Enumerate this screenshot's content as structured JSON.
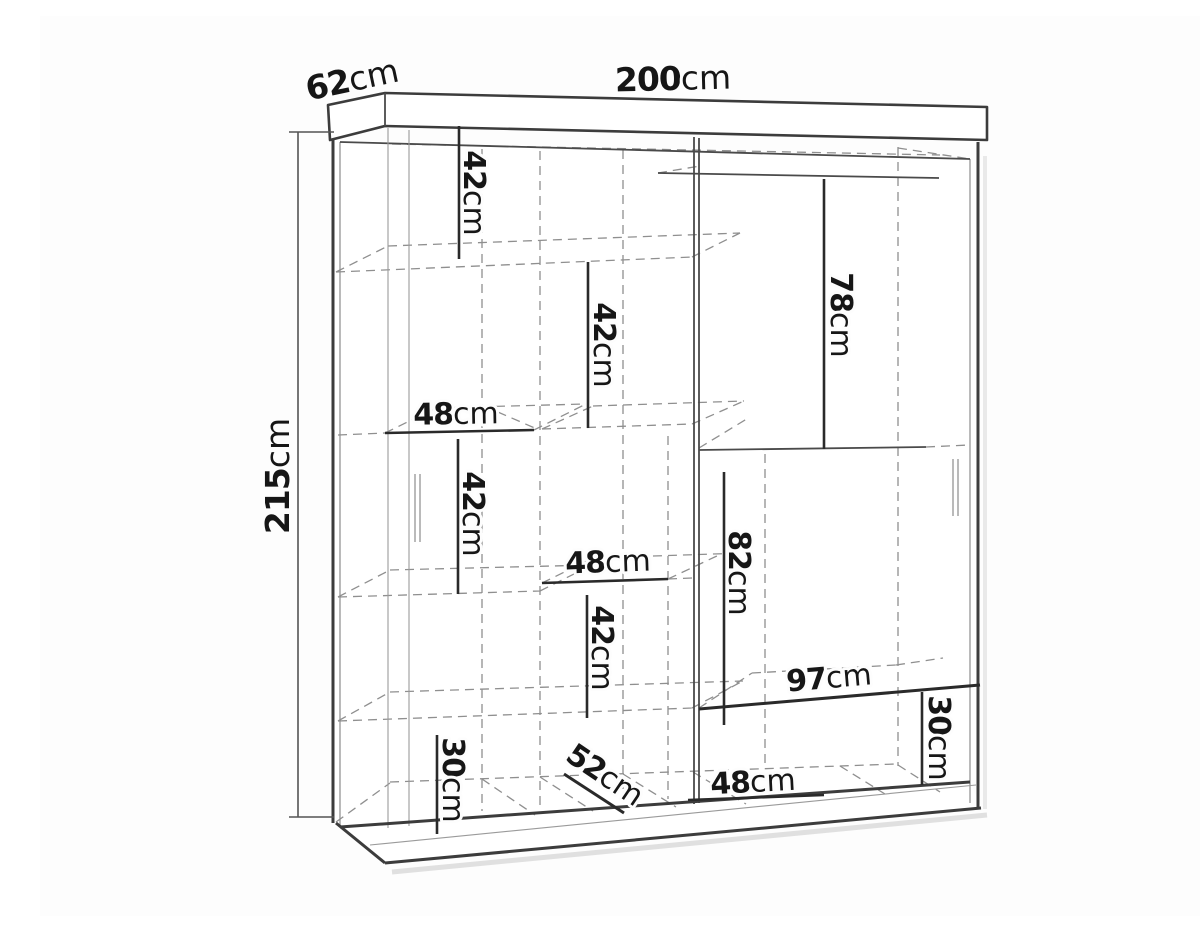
{
  "diagram": {
    "description": "Technical dimension line drawing of a two-door sliding wardrobe shown in perspective with internal shelf measurements",
    "unit": "cm",
    "background_color": "#fdfdfd",
    "line_color": "#3c3c3c",
    "hidden_line_color": "#8f8f8f",
    "text_color": "#161616"
  },
  "overall": {
    "width": {
      "num": "200",
      "unit": "cm"
    },
    "depth": {
      "num": "62",
      "unit": "cm"
    },
    "height": {
      "num": "215",
      "unit": "cm"
    }
  },
  "internal": {
    "i1": {
      "num": "42",
      "unit": "cm"
    },
    "i2": {
      "num": "42",
      "unit": "cm"
    },
    "i3": {
      "num": "78",
      "unit": "cm"
    },
    "i4": {
      "num": "48",
      "unit": "cm"
    },
    "i5": {
      "num": "42",
      "unit": "cm"
    },
    "i6": {
      "num": "48",
      "unit": "cm"
    },
    "i7": {
      "num": "82",
      "unit": "cm"
    },
    "i8": {
      "num": "42",
      "unit": "cm"
    },
    "i9": {
      "num": "97",
      "unit": "cm"
    },
    "i10": {
      "num": "30",
      "unit": "cm"
    },
    "i11": {
      "num": "30",
      "unit": "cm"
    },
    "i12": {
      "num": "52",
      "unit": "cm"
    },
    "i13": {
      "num": "48",
      "unit": "cm"
    }
  }
}
